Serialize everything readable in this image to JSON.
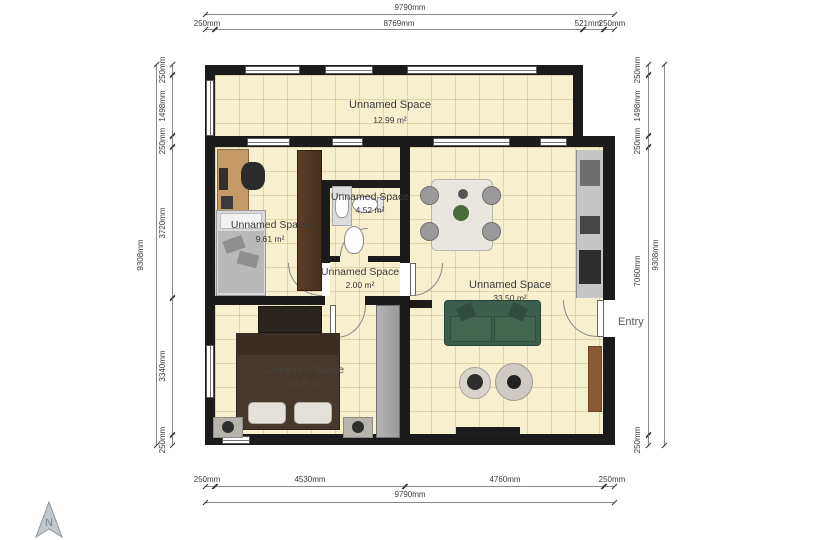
{
  "compass": {
    "label": "N"
  },
  "entry": {
    "label": "Entry"
  },
  "rooms": {
    "balcony": {
      "name": "Unnamed Space",
      "area": "12.99 m²"
    },
    "office": {
      "name": "Unnamed Space",
      "area": "9.61 m²"
    },
    "bathroom": {
      "name": "Unnamed Space",
      "area": "4.52 m²"
    },
    "hall": {
      "name": "Unnamed Space",
      "area": "2.00 m²"
    },
    "living": {
      "name": "Unnamed Space",
      "area": "33.50 m²"
    },
    "bedroom": {
      "name": "Unnamed Space",
      "area": "14.85 m²"
    }
  },
  "dimensions": {
    "top": {
      "total": "9790mm",
      "segments": [
        "250mm",
        "8769mm",
        "521mm",
        "250mm"
      ]
    },
    "bottom": {
      "total": "9790mm",
      "segments": [
        "250mm",
        "4530mm",
        "4760mm",
        "250mm"
      ]
    },
    "left": {
      "total": "9308mm",
      "segments": [
        "250mm",
        "1498mm",
        "250mm",
        "3720mm",
        "3340mm",
        "250mm"
      ]
    },
    "right": {
      "total": "9308mm",
      "segments": [
        "250mm",
        "1498mm",
        "250mm",
        "7060mm",
        "250mm"
      ]
    }
  },
  "colors": {
    "floor": "#f7f0cf",
    "wall": "#1b1b1b",
    "sofa": "#3c5e4d",
    "desk_wood": "#c49a66",
    "wardrobe": "#46301d",
    "kitchen_counter": "#c6c6c6",
    "bed_blanket": "#46382c",
    "cabinet_brown": "#8a5a36",
    "dim_text": "#3c3c3c"
  }
}
